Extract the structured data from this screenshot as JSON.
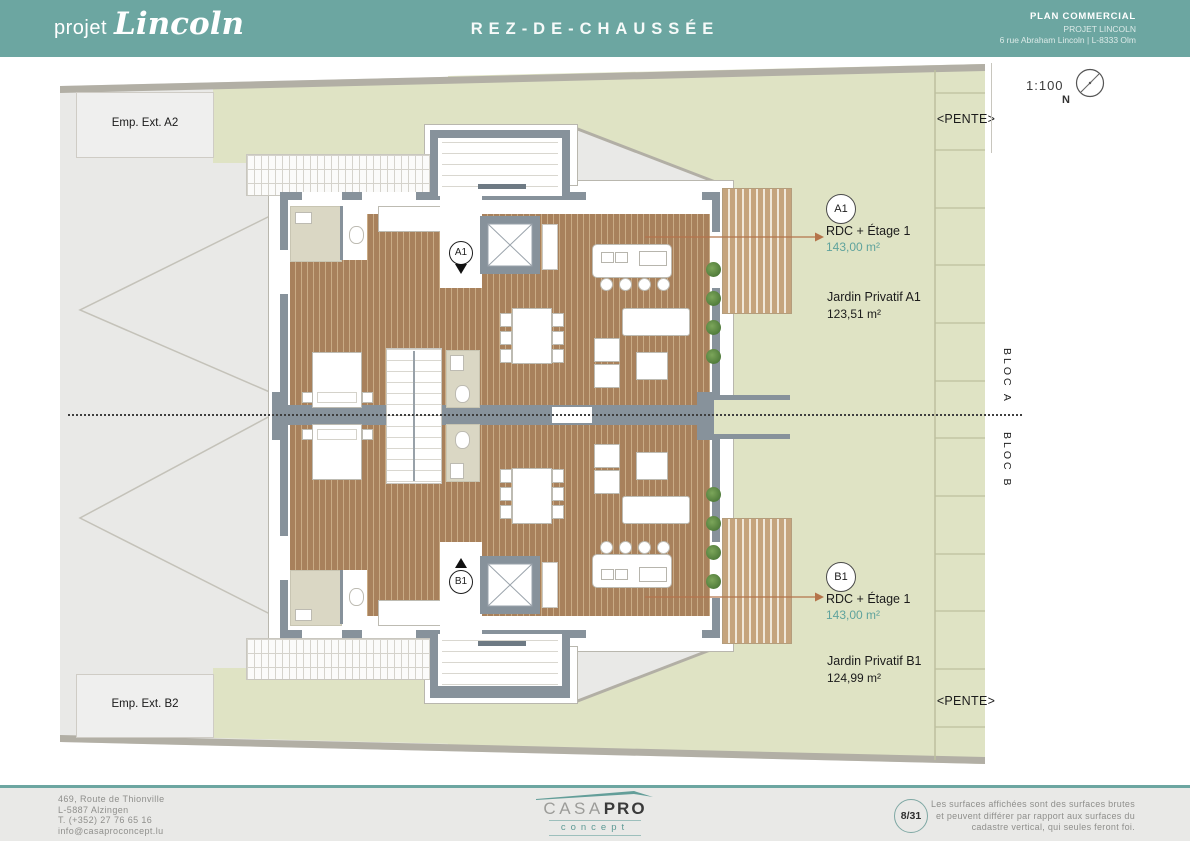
{
  "header": {
    "logo_prefix": "projet",
    "logo_name": "Lincoln",
    "title": "REZ-DE-CHAUSSÉE",
    "doc_type": "PLAN COMMERCIAL",
    "project_name": "PROJET LINCOLN",
    "project_address": "6 rue Abraham Lincoln | L-8333 Olm"
  },
  "plan": {
    "scale": "1:100",
    "north_label": "N",
    "parking_a_label": "Emp. Ext. A2",
    "parking_b_label": "Emp. Ext. B2",
    "pente_top": "<PENTE>",
    "pente_bottom": "<PENTE>",
    "bloc_a": "BLOC A",
    "bloc_b": "BLOC B",
    "unit_a": {
      "marker": "A1",
      "badge": "A1",
      "floors": "RDC + Étage 1",
      "area": "143,00 m²",
      "garden_label": "Jardin Privatif  A1",
      "garden_area": "123,51 m²"
    },
    "unit_b": {
      "marker": "B1",
      "badge": "B1",
      "floors": "RDC + Étage 1",
      "area": "143,00 m²",
      "garden_label": "Jardin Privatif  B1",
      "garden_area": "124,99 m²"
    }
  },
  "footer": {
    "address_lines": [
      "469, Route de Thionville",
      "L-5887 Alzingen",
      "T. (+352) 27 76 65 16",
      "info@casaproconcept.lu"
    ],
    "logo": {
      "part1": "CASA",
      "part2": "PRO",
      "subtitle": "concept"
    },
    "page_indicator": "8/31",
    "disclaimer_lines": [
      "Les surfaces affichées sont des surfaces brutes",
      "et peuvent différer par rapport aux surfaces du",
      "cadastre vertical, qui seules feront foi."
    ]
  },
  "colors": {
    "brand_teal": "#6CA6A1",
    "area_accent_text": "#5FA39D",
    "garden_green": "#DFE3C4",
    "wood_brown": "#B08B66",
    "wall_gray": "#87929B",
    "leader_orange": "#B5744B"
  }
}
